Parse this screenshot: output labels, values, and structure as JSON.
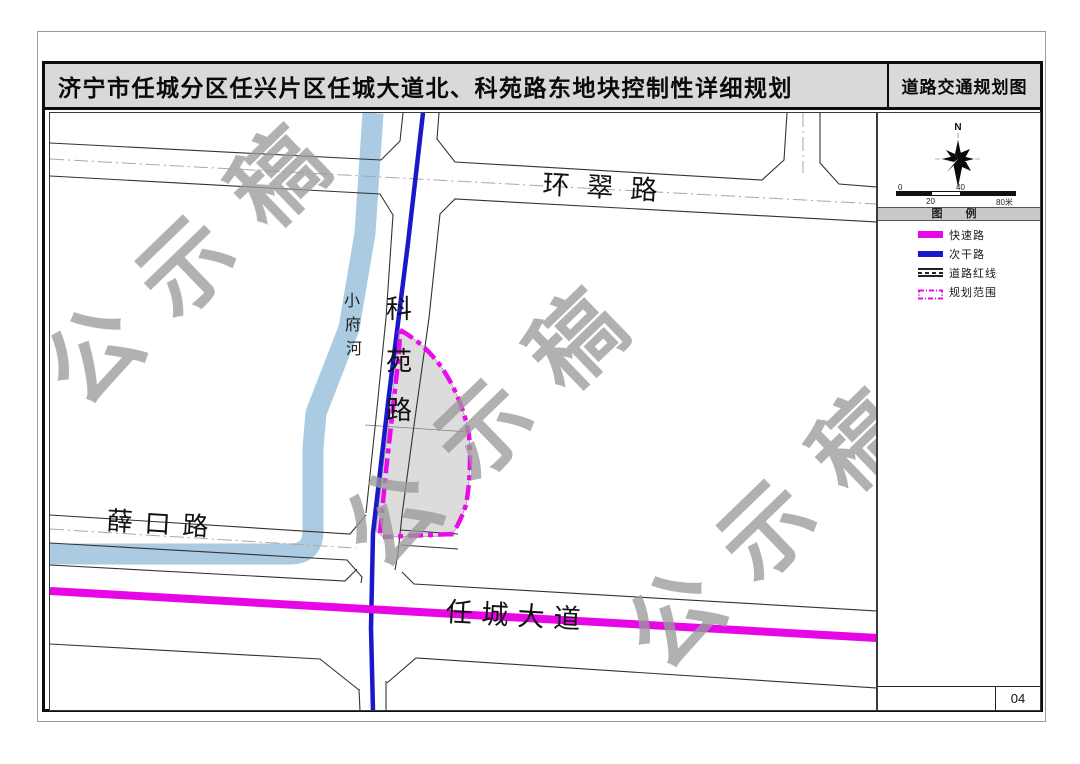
{
  "title": {
    "main": "济宁市任城分区任兴片区任城大道北、科苑路东地块控制性详细规划",
    "sheet_name": "道路交通规划图"
  },
  "map": {
    "watermark_text": "公示稿",
    "roads": {
      "huancui": "环翠路",
      "xuekou": "薛口路",
      "rencheng": "任城大道",
      "keyuan_chars": [
        "科",
        "苑",
        "路"
      ]
    },
    "river_chars": [
      "小",
      "府",
      "河"
    ]
  },
  "panel": {
    "compass_label": "N",
    "scale": {
      "zero": "0",
      "mid_top": "40",
      "mid_bottom": "20",
      "end": "80米"
    },
    "legend": {
      "header": "图    例",
      "items": [
        {
          "label": "快速路"
        },
        {
          "label": "次干路"
        },
        {
          "label": "道路红线"
        },
        {
          "label": "规划范围"
        }
      ]
    },
    "page_number": "04"
  },
  "colors": {
    "expressway": "#e606e6",
    "secondary_road": "#1b18cb",
    "planning_boundary": "#ea0bea",
    "river": "#aacbe1",
    "parcel_fill": "#dcdcdc",
    "watermark": "#9b9b9b",
    "titlebar_bg": "#d9d9d9"
  }
}
